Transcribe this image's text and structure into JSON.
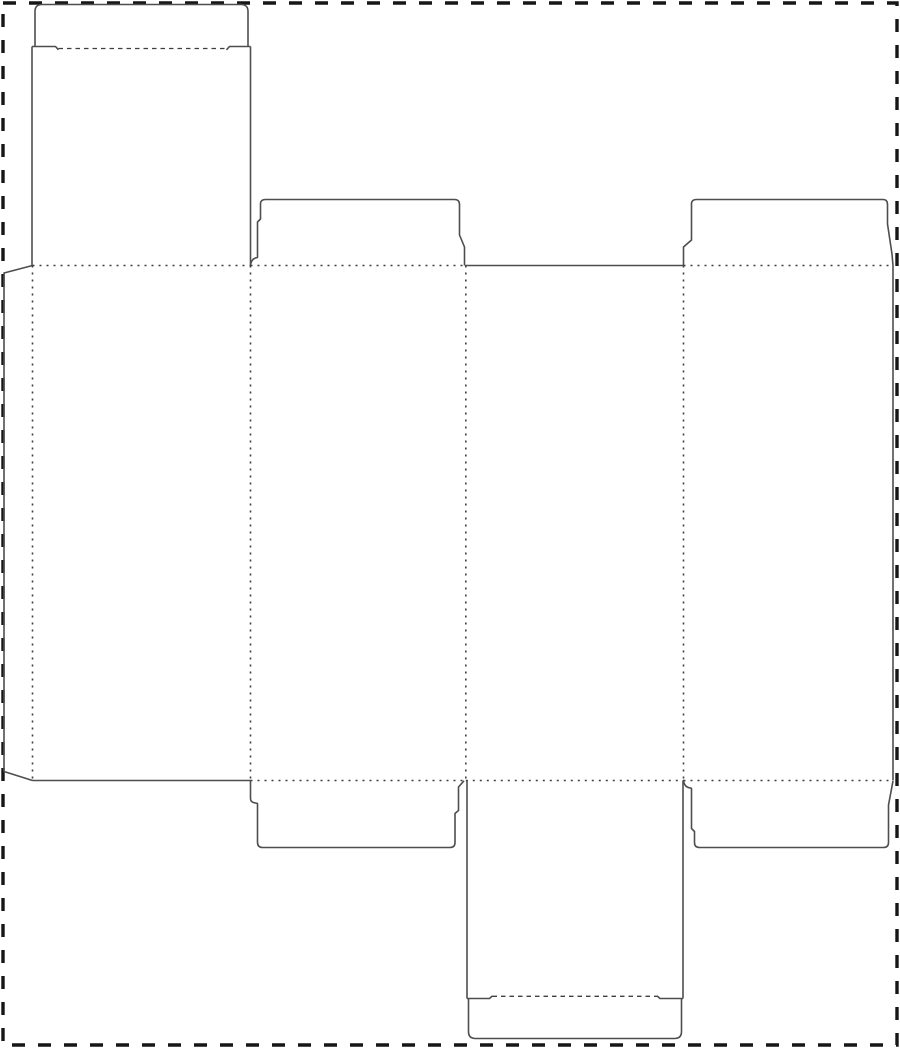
{
  "page": {
    "width": 900,
    "height": 1048,
    "background": "#ffffff",
    "border": {
      "x": 3,
      "y": 3,
      "width": 894,
      "height": 1042,
      "color": "#161616",
      "stroke_width": 3.4,
      "dash": "13 13"
    }
  },
  "dieline": {
    "description": "folding-carton-box-dieline-template",
    "styles": {
      "cut": {
        "color": "#4e4e4e",
        "width": 1.6,
        "dash": ""
      },
      "fold_dotted": {
        "color": "#3e3e3e",
        "width": 1.6,
        "dash": "2 5"
      },
      "fold_dashed": {
        "color": "#3e3e3e",
        "width": 1.3,
        "dash": "4.5 4"
      }
    },
    "paths": [
      {
        "name": "glue-flap-cut",
        "style": "cut",
        "d": "M 32.5 265.5 L 4 273 L 4 771.5 L 32.5 780.5"
      },
      {
        "name": "top-tuck-lid-cut",
        "style": "cut",
        "d": "M 35 46.5 L 35 11.5 Q 35 4.5 42 4.5 L 241 4.5 Q 248 4.5 248 11.5 L 248 46.5"
      },
      {
        "name": "top-tuck-shoulder-left-cut",
        "style": "cut",
        "d": "M 32 46.5 L 55.5 46.5 L 58.5 49.8"
      },
      {
        "name": "top-tuck-shoulder-right-cut",
        "style": "cut",
        "d": "M 226.5 49.8 L 229.5 46.5 L 250.5 46.5"
      },
      {
        "name": "top-tall-flap-left-edge-cut",
        "style": "cut",
        "d": "M 32 46.5 L 32 265.5"
      },
      {
        "name": "top-tall-flap-right-edge-cut",
        "style": "cut",
        "d": "M 250.5 46.5 L 250.5 265.5"
      },
      {
        "name": "top-dust-flap-left-cut",
        "style": "cut",
        "d": "M 250.5 265.5 C 251 260.5 253.5 258 257.5 257.5 L 257.5 222 L 260.5 219 L 260.5 204 Q 260.5 199.5 265.5 199.5 L 454.5 199.5 Q 459.5 199.5 459.5 204.5 L 459.5 235 L 464.5 247 L 464.5 265.5"
      },
      {
        "name": "top-dust-flap-right-cut",
        "style": "cut",
        "d": "M 683.5 265.5 L 683.5 247 L 691.5 240 L 691.5 204 Q 691.5 199.5 696.5 199.5 L 883 199.5 Q 887.5 199.5 887.5 204.5 L 887.5 224 L 892 254 L 893 265.5"
      },
      {
        "name": "panel3-top-edge-cut",
        "style": "cut",
        "d": "M 465 265.5 L 683.5 265.5"
      },
      {
        "name": "panel1-bottom-edge-cut",
        "style": "cut",
        "d": "M 32.5 780.5 L 250.5 780.5"
      },
      {
        "name": "right-side-edge-cut",
        "style": "cut",
        "d": "M 893 265.5 L 893 780.5"
      },
      {
        "name": "bottom-dust-flap-left-cut",
        "style": "cut",
        "d": "M 250.5 780.5 L 250.5 798.5 Q 250.5 802.5 255.5 803 L 257.5 803.5 L 257.5 842 Q 257.5 847.5 262.5 847.5 L 450 847.5 Q 455 847.5 455 842.5 L 455 813.5 L 458.5 810.5 L 458.5 787 L 464 780.8"
      },
      {
        "name": "bottom-dust-flap-right-cut",
        "style": "cut",
        "d": "M 683.5 780.5 C 684 785.5 686.5 787.5 690.5 788 L 691.5 788.5 L 691.5 828.5 L 694.5 831.5 L 694.5 842.5 Q 694.5 847.5 699.5 847.5 L 883.5 847.5 Q 888.5 847.5 888.5 842.5 L 888.5 805 L 893 781"
      },
      {
        "name": "bottom-tall-flap-left-edge-cut",
        "style": "cut",
        "d": "M 467 780.5 L 467 998.5"
      },
      {
        "name": "bottom-tall-flap-right-edge-cut",
        "style": "cut",
        "d": "M 683 780.5 L 683 998.5"
      },
      {
        "name": "bottom-tuck-shoulder-left-cut",
        "style": "cut",
        "d": "M 467 998.5 L 489.5 998.5 L 492.5 995.8"
      },
      {
        "name": "bottom-tuck-shoulder-right-cut",
        "style": "cut",
        "d": "M 657 995.8 L 660 998.5 L 683 998.5"
      },
      {
        "name": "bottom-tuck-lid-cut",
        "style": "cut",
        "d": "M 468.5 998.5 L 468.5 1031.5 Q 468.5 1038.5 475.5 1038.5 L 674.5 1038.5 Q 681.5 1038.5 681.5 1031.5 L 681.5 998.5"
      },
      {
        "name": "fold-glue-flap-vertical",
        "style": "fold_dotted",
        "d": "M 32.5 265.5 L 32.5 780.5"
      },
      {
        "name": "fold-panel1-panel2-vertical",
        "style": "fold_dotted",
        "d": "M 250.5 265.5 L 250.5 780.5"
      },
      {
        "name": "fold-panel2-panel3-vertical",
        "style": "fold_dotted",
        "d": "M 465.8 265.5 L 465.8 780.5"
      },
      {
        "name": "fold-panel3-panel4-vertical",
        "style": "fold_dotted",
        "d": "M 683.5 265.5 L 683.5 780.5"
      },
      {
        "name": "fold-top-panel1-horizontal",
        "style": "fold_dotted",
        "d": "M 32.5 265.5 L 250.5 265.5"
      },
      {
        "name": "fold-top-panel2-horizontal",
        "style": "fold_dotted",
        "d": "M 250.5 265.5 L 465 265.5"
      },
      {
        "name": "fold-top-panel4-horizontal",
        "style": "fold_dotted",
        "d": "M 683.5 265.5 L 893 265.5"
      },
      {
        "name": "fold-bottom-panel2-horizontal",
        "style": "fold_dotted",
        "d": "M 250.5 780.5 L 465.8 780.5"
      },
      {
        "name": "fold-bottom-panel3-horizontal",
        "style": "fold_dotted",
        "d": "M 465.8 780.5 L 683.5 780.5"
      },
      {
        "name": "fold-bottom-panel4-horizontal",
        "style": "fold_dotted",
        "d": "M 683.5 780.5 L 893 780.5"
      },
      {
        "name": "fold-top-tuck-dashed",
        "style": "fold_dashed",
        "d": "M 58.5 48.5 L 226.5 48.5"
      },
      {
        "name": "fold-bottom-tuck-dashed",
        "style": "fold_dashed",
        "d": "M 492.5 996.3 L 657 996.3"
      }
    ]
  }
}
